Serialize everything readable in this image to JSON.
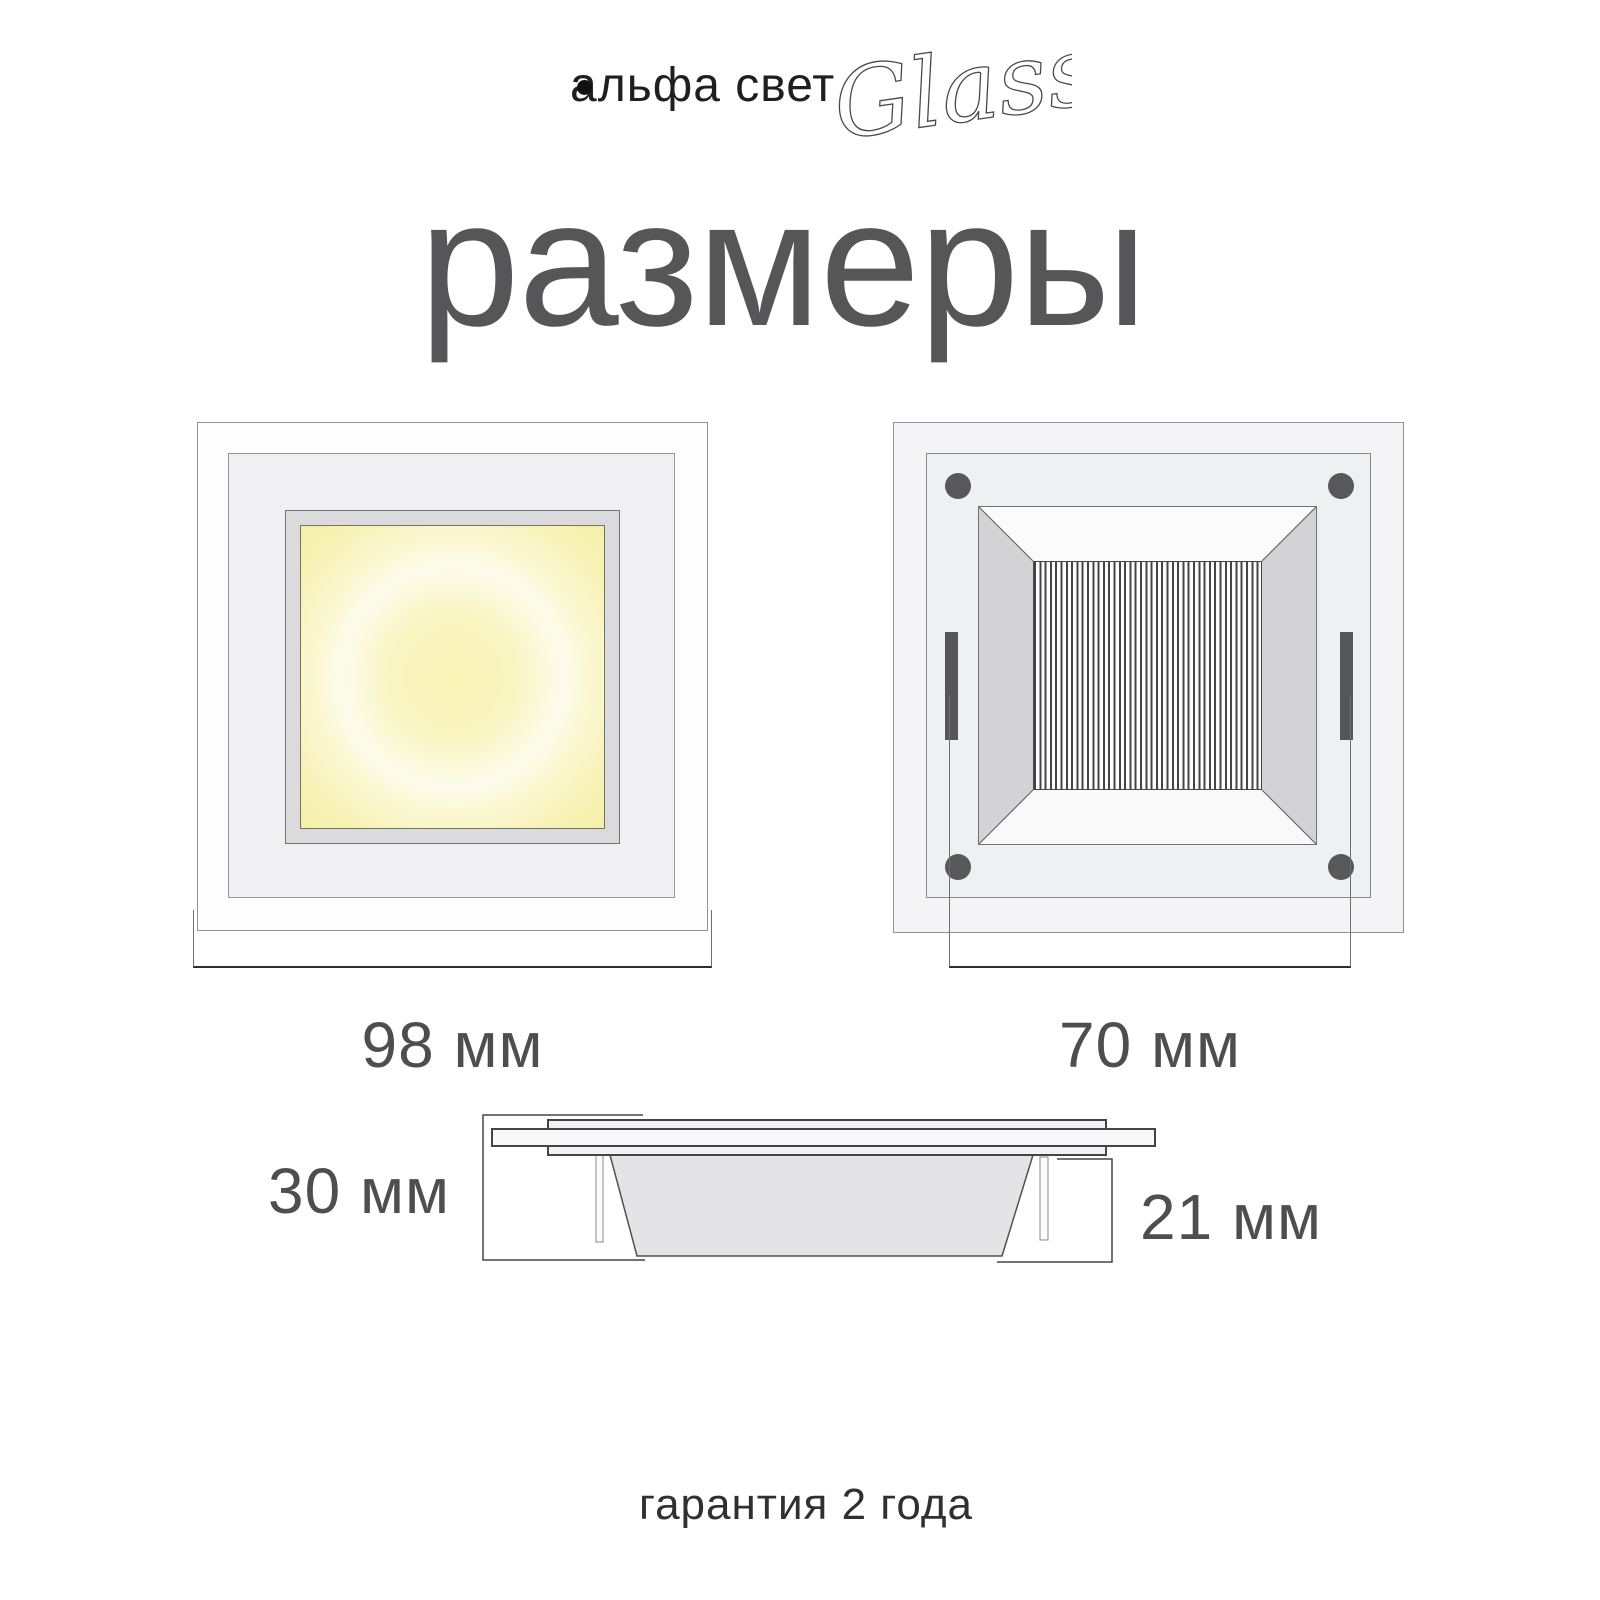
{
  "brand": {
    "logo": "альфа свет",
    "collection": "Glass"
  },
  "title": "размеры",
  "dimensions": {
    "front_width": "98 мм",
    "back_width": "70 мм",
    "side_height": "30 мм",
    "side_recess": "21 мм"
  },
  "footer": {
    "warranty": "гарантия 2 года"
  },
  "colors": {
    "title_text": "#565659",
    "dimension_text": "#4e4e51",
    "logo_text": "#1f1f21",
    "glow_center": "#f8f3b6",
    "glow_ring": "#fdfcec",
    "metal_dark": "#58585a",
    "bezel_side": "#d3d3d5",
    "bezel_face": "#fbfbfc",
    "panel_light": "#f0f0f2",
    "glass_light": "#f4f4f6"
  }
}
